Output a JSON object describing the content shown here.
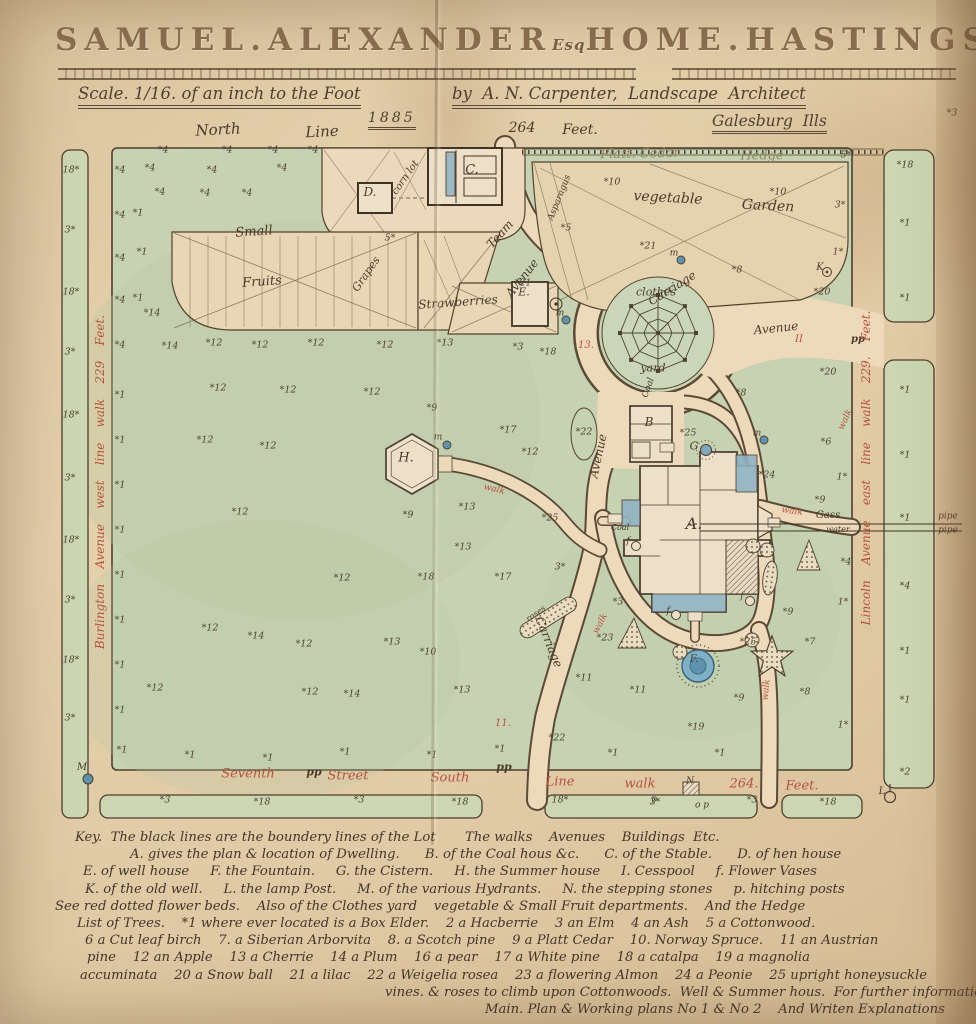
{
  "header": {
    "title_1": "SAMUEL.",
    "title_2": "ALEXANDER",
    "title_esq": "Esq",
    "title_3": "HOME.",
    "title_4": "HASTINGS.",
    "title_5": "NEB.",
    "scale": "Scale. 1/16. of an inch to the Foot",
    "byline": "by  A. N. Carpenter,  Landscape  Architect",
    "place": "Galesburg  Ills",
    "date": "1885"
  },
  "colors": {
    "paper": "#dcc6a2",
    "lawn": "#c6d2b2",
    "road_tan": "#eedaba",
    "ink": "#52432f",
    "red_script": "#b8523d",
    "water_blue": "#7fa8bd"
  },
  "map": {
    "labels": [
      {
        "n": "north-line-label",
        "t": "North",
        "x": 218,
        "y": 130,
        "r": -3,
        "s": 15
      },
      {
        "n": "north-line-label",
        "t": "Line",
        "x": 322,
        "y": 132,
        "r": -3,
        "s": 15
      },
      {
        "n": "north-feet-label",
        "t": "264",
        "x": 522,
        "y": 128,
        "s": 14
      },
      {
        "n": "north-feet-label",
        "t": "Feet.",
        "x": 580,
        "y": 130,
        "s": 14
      },
      {
        "n": "hedge-label",
        "t": "Platt. Cedar",
        "x": 640,
        "y": 154,
        "r": -1,
        "s": 13,
        "c": "faded"
      },
      {
        "n": "hedge-label",
        "t": "Hedge",
        "x": 762,
        "y": 156,
        "s": 13,
        "c": "faded"
      },
      {
        "n": "vegetable-garden-label",
        "t": "vegetable",
        "x": 668,
        "y": 198,
        "r": 3,
        "s": 14
      },
      {
        "n": "vegetable-garden-label",
        "t": "Garden",
        "x": 768,
        "y": 206,
        "r": 3,
        "s": 14
      },
      {
        "n": "asparagus-label",
        "t": "Asparagus",
        "x": 560,
        "y": 198,
        "r": -68,
        "s": 9
      },
      {
        "n": "corn-lot-label",
        "t": "corn lot",
        "x": 406,
        "y": 178,
        "r": -55,
        "s": 10
      },
      {
        "n": "small-fruits-label",
        "t": "Small",
        "x": 254,
        "y": 232,
        "r": -4,
        "s": 13
      },
      {
        "n": "small-fruits-label",
        "t": "Fruits",
        "x": 262,
        "y": 282,
        "r": -4,
        "s": 13
      },
      {
        "n": "grapes-label",
        "t": "Grapes",
        "x": 366,
        "y": 274,
        "r": -55,
        "s": 11
      },
      {
        "n": "strawberries-label",
        "t": "Strawberries",
        "x": 458,
        "y": 302,
        "r": -4,
        "s": 12
      },
      {
        "n": "team-avenue-label",
        "t": "Team",
        "x": 500,
        "y": 234,
        "r": -48,
        "s": 12
      },
      {
        "n": "team-avenue-label",
        "t": "Avenue",
        "x": 522,
        "y": 278,
        "r": -52,
        "s": 12
      },
      {
        "n": "carriage-avenue-label",
        "t": "Carriage",
        "x": 672,
        "y": 288,
        "r": -32,
        "s": 12
      },
      {
        "n": "carriage-avenue-label",
        "t": "Avenue",
        "x": 776,
        "y": 328,
        "r": -6,
        "s": 12
      },
      {
        "n": "clothes-yard-label",
        "t": "clothes",
        "x": 656,
        "y": 292,
        "s": 11
      },
      {
        "n": "clothes-yard-label",
        "t": "yard",
        "x": 653,
        "y": 368,
        "s": 11
      },
      {
        "n": "avenue-label",
        "t": "Avenue",
        "x": 598,
        "y": 456,
        "r": -78,
        "s": 12
      },
      {
        "n": "carriage-drive-label",
        "t": "Carriage",
        "x": 549,
        "y": 642,
        "r": 68,
        "s": 12
      },
      {
        "n": "coal-label",
        "t": "Coal",
        "x": 649,
        "y": 388,
        "r": -70,
        "s": 9
      },
      {
        "n": "coal-label",
        "t": "Coal",
        "x": 620,
        "y": 528,
        "s": 8
      },
      {
        "n": "gas-pipe-label",
        "t": "Gass",
        "x": 828,
        "y": 516,
        "s": 10
      },
      {
        "n": "water-pipe-label",
        "t": "water",
        "x": 838,
        "y": 530,
        "s": 8
      },
      {
        "n": "pipe-label",
        "t": "pipe",
        "x": 948,
        "y": 517,
        "s": 9
      },
      {
        "n": "pipe-label",
        "t": "pipe",
        "x": 948,
        "y": 531,
        "s": 9
      },
      {
        "n": "roses-bed-label",
        "t": "roses",
        "x": 536,
        "y": 614,
        "r": -35,
        "s": 8
      },
      {
        "n": "walk-label",
        "t": "walk",
        "x": 494,
        "y": 490,
        "r": 14,
        "s": 9,
        "c": "red"
      },
      {
        "n": "walk-label",
        "t": "walk",
        "x": 792,
        "y": 512,
        "r": 8,
        "s": 9,
        "c": "red"
      },
      {
        "n": "walk-label",
        "t": "walk",
        "x": 601,
        "y": 624,
        "r": -62,
        "s": 9,
        "c": "red"
      },
      {
        "n": "walk-label",
        "t": "walk",
        "x": 767,
        "y": 690,
        "r": -84,
        "s": 9,
        "c": "red"
      },
      {
        "n": "walk-label",
        "t": "walk",
        "x": 846,
        "y": 420,
        "r": -65,
        "s": 9,
        "c": "red"
      },
      {
        "n": "station-mark",
        "t": "13.",
        "x": 586,
        "y": 346,
        "s": 10,
        "c": "red"
      },
      {
        "n": "station-mark",
        "t": "11.",
        "x": 503,
        "y": 724,
        "s": 10,
        "c": "red"
      },
      {
        "n": "station-mark",
        "t": "II",
        "x": 799,
        "y": 340,
        "s": 10,
        "c": "red"
      },
      {
        "n": "hitching-posts-mark",
        "t": "pp",
        "x": 314,
        "y": 772,
        "s": 11,
        "b": 1
      },
      {
        "n": "hitching-posts-mark",
        "t": "pp",
        "x": 504,
        "y": 767,
        "s": 11,
        "b": 1
      },
      {
        "n": "hitching-posts-mark",
        "t": "pp",
        "x": 858,
        "y": 340,
        "s": 10,
        "b": 1
      },
      {
        "n": "post-mark",
        "t": "p",
        "x": 654,
        "y": 800,
        "s": 9
      },
      {
        "n": "post-mark",
        "t": "o p",
        "x": 702,
        "y": 806,
        "s": 9
      },
      {
        "n": "west-street-label",
        "t": "Burlington    Avenue    west    line    walk    229    Feet.",
        "x": 100,
        "y": 482,
        "r": -90,
        "s": 12,
        "c": "red"
      },
      {
        "n": "east-street-label",
        "t": "Lincoln    Avenue    east    line    walk    229.    Feet.",
        "x": 866,
        "y": 468,
        "r": -90,
        "s": 12,
        "c": "red"
      },
      {
        "n": "south-street-label",
        "t": "Seventh",
        "x": 248,
        "y": 774,
        "s": 13,
        "c": "red"
      },
      {
        "n": "south-street-label",
        "t": "Street",
        "x": 348,
        "y": 776,
        "s": 13,
        "c": "red"
      },
      {
        "n": "south-street-label",
        "t": "South",
        "x": 450,
        "y": 778,
        "s": 13,
        "c": "red"
      },
      {
        "n": "south-street-label",
        "t": "Line",
        "x": 560,
        "y": 782,
        "s": 13,
        "c": "red"
      },
      {
        "n": "south-street-label",
        "t": "walk",
        "x": 640,
        "y": 784,
        "s": 13,
        "c": "red"
      },
      {
        "n": "south-street-label",
        "t": "264.",
        "x": 744,
        "y": 784,
        "s": 13,
        "c": "red"
      },
      {
        "n": "south-street-label",
        "t": "Feet.",
        "x": 802,
        "y": 786,
        "s": 13,
        "c": "red"
      },
      {
        "n": "label-stable-C",
        "t": "C.",
        "x": 472,
        "y": 170,
        "s": 13
      },
      {
        "n": "label-hen-house-D",
        "t": "D.",
        "x": 370,
        "y": 192,
        "s": 12
      },
      {
        "n": "label-coal-house-B",
        "t": "B",
        "x": 649,
        "y": 422,
        "s": 12
      },
      {
        "n": "label-well-house-E",
        "t": "E.",
        "x": 524,
        "y": 292,
        "s": 11
      },
      {
        "n": "label-dwelling-A",
        "t": "A.",
        "x": 694,
        "y": 524,
        "s": 16
      },
      {
        "n": "label-summer-house-H",
        "t": "H.",
        "x": 406,
        "y": 458,
        "s": 13
      },
      {
        "n": "label-fountain-F",
        "t": "F.",
        "x": 694,
        "y": 660,
        "s": 10
      },
      {
        "n": "label-cistern-G",
        "t": "G",
        "x": 694,
        "y": 446,
        "s": 11
      },
      {
        "n": "label-old-well-K",
        "t": "K",
        "x": 820,
        "y": 268,
        "s": 10
      },
      {
        "n": "label-stepping-stones-N",
        "t": "N",
        "x": 690,
        "y": 782,
        "s": 9
      },
      {
        "n": "label-lamp-post-L",
        "t": "L",
        "x": 882,
        "y": 792,
        "s": 10
      },
      {
        "n": "label-hydrant-M",
        "t": "M",
        "x": 82,
        "y": 768,
        "s": 10
      },
      {
        "n": "hydrant-label",
        "t": "m",
        "x": 560,
        "y": 314,
        "s": 9
      },
      {
        "n": "hydrant-label",
        "t": "m",
        "x": 757,
        "y": 434,
        "s": 9
      },
      {
        "n": "hydrant-label",
        "t": "m",
        "x": 438,
        "y": 438,
        "s": 9
      },
      {
        "n": "hydrant-label",
        "t": "m",
        "x": 674,
        "y": 254,
        "s": 9
      },
      {
        "n": "flower-vase-label",
        "t": "f",
        "x": 628,
        "y": 542,
        "s": 9
      },
      {
        "n": "flower-vase-label",
        "t": "f",
        "x": 742,
        "y": 597,
        "s": 9
      },
      {
        "n": "flower-vase-label",
        "t": "f",
        "x": 668,
        "y": 612,
        "s": 9
      }
    ],
    "trees": [
      [
        163,
        150,
        "*4"
      ],
      [
        227,
        150,
        "*4"
      ],
      [
        273,
        150,
        "*4"
      ],
      [
        313,
        150,
        "*4"
      ],
      [
        150,
        168,
        "*4"
      ],
      [
        212,
        170,
        "*4"
      ],
      [
        282,
        168,
        "*4"
      ],
      [
        160,
        192,
        "*4"
      ],
      [
        205,
        193,
        "*4"
      ],
      [
        247,
        193,
        "*4"
      ],
      [
        138,
        213,
        "*1"
      ],
      [
        142,
        252,
        "*1"
      ],
      [
        138,
        298,
        "*1"
      ],
      [
        152,
        313,
        "*14"
      ],
      [
        120,
        170,
        "*4"
      ],
      [
        120,
        215,
        "*4"
      ],
      [
        120,
        258,
        "*4"
      ],
      [
        120,
        300,
        "*4"
      ],
      [
        120,
        345,
        "*4"
      ],
      [
        120,
        395,
        "*1"
      ],
      [
        120,
        440,
        "*1"
      ],
      [
        120,
        485,
        "*1"
      ],
      [
        120,
        530,
        "*1"
      ],
      [
        120,
        575,
        "*1"
      ],
      [
        120,
        620,
        "*1"
      ],
      [
        120,
        665,
        "*1"
      ],
      [
        120,
        710,
        "*1"
      ],
      [
        122,
        750,
        "*1"
      ],
      [
        71,
        170,
        "18*"
      ],
      [
        70,
        230,
        "3*"
      ],
      [
        71,
        292,
        "18*"
      ],
      [
        70,
        352,
        "3*"
      ],
      [
        71,
        415,
        "18*"
      ],
      [
        70,
        478,
        "3*"
      ],
      [
        71,
        540,
        "18*"
      ],
      [
        70,
        600,
        "3*"
      ],
      [
        71,
        660,
        "18*"
      ],
      [
        70,
        718,
        "3*"
      ],
      [
        170,
        346,
        "*14"
      ],
      [
        214,
        343,
        "*12"
      ],
      [
        260,
        345,
        "*12"
      ],
      [
        316,
        343,
        "*12"
      ],
      [
        385,
        345,
        "*12"
      ],
      [
        445,
        343,
        "*13"
      ],
      [
        518,
        347,
        "*3"
      ],
      [
        548,
        352,
        "*18"
      ],
      [
        218,
        388,
        "*12"
      ],
      [
        288,
        390,
        "*12"
      ],
      [
        372,
        392,
        "*12"
      ],
      [
        432,
        408,
        "*9"
      ],
      [
        205,
        440,
        "*12"
      ],
      [
        268,
        446,
        "*12"
      ],
      [
        508,
        430,
        "*17"
      ],
      [
        530,
        452,
        "*12"
      ],
      [
        240,
        512,
        "*12"
      ],
      [
        408,
        515,
        "*9"
      ],
      [
        467,
        507,
        "*13"
      ],
      [
        550,
        518,
        "*25"
      ],
      [
        463,
        547,
        "*13"
      ],
      [
        342,
        578,
        "*12"
      ],
      [
        426,
        577,
        "*18"
      ],
      [
        503,
        577,
        "*17"
      ],
      [
        560,
        567,
        "3*"
      ],
      [
        155,
        688,
        "*12"
      ],
      [
        210,
        628,
        "*12"
      ],
      [
        256,
        636,
        "*14"
      ],
      [
        304,
        644,
        "*12"
      ],
      [
        392,
        642,
        "*13"
      ],
      [
        428,
        652,
        "*10"
      ],
      [
        310,
        692,
        "*12"
      ],
      [
        352,
        694,
        "*14"
      ],
      [
        462,
        690,
        "*13"
      ],
      [
        190,
        755,
        "*1"
      ],
      [
        268,
        758,
        "*1"
      ],
      [
        345,
        752,
        "*1"
      ],
      [
        432,
        755,
        "*1"
      ],
      [
        500,
        749,
        "*1"
      ],
      [
        584,
        678,
        "*11"
      ],
      [
        638,
        690,
        "*11"
      ],
      [
        557,
        738,
        "*22"
      ],
      [
        613,
        753,
        "*1"
      ],
      [
        696,
        727,
        "*19"
      ],
      [
        739,
        698,
        "*9"
      ],
      [
        720,
        753,
        "*1"
      ],
      [
        618,
        602,
        "*3"
      ],
      [
        605,
        638,
        "*23"
      ],
      [
        748,
        642,
        "*25"
      ],
      [
        826,
        442,
        "*6"
      ],
      [
        741,
        393,
        "*8"
      ],
      [
        828,
        372,
        "*20"
      ],
      [
        820,
        500,
        "*9"
      ],
      [
        842,
        477,
        "1*"
      ],
      [
        846,
        562,
        "*4"
      ],
      [
        810,
        642,
        "*7"
      ],
      [
        843,
        602,
        "1*"
      ],
      [
        805,
        692,
        "*8"
      ],
      [
        843,
        725,
        "1*"
      ],
      [
        788,
        612,
        "*9"
      ],
      [
        846,
        155,
        "5*"
      ],
      [
        840,
        205,
        "3*"
      ],
      [
        838,
        252,
        "1*"
      ],
      [
        822,
        292,
        "*20"
      ],
      [
        612,
        182,
        "*10"
      ],
      [
        778,
        192,
        "*10"
      ],
      [
        737,
        270,
        "*8"
      ],
      [
        648,
        246,
        "*21"
      ],
      [
        566,
        228,
        "*5"
      ],
      [
        523,
        283,
        "*21"
      ],
      [
        390,
        238,
        "5*"
      ],
      [
        688,
        433,
        "*25"
      ],
      [
        767,
        475,
        "*24"
      ],
      [
        584,
        432,
        "*22"
      ],
      [
        905,
        165,
        "*18"
      ],
      [
        905,
        223,
        "*1"
      ],
      [
        905,
        298,
        "*1"
      ],
      [
        905,
        390,
        "*1"
      ],
      [
        905,
        455,
        "*1"
      ],
      [
        905,
        518,
        "*1"
      ],
      [
        905,
        586,
        "*4"
      ],
      [
        905,
        651,
        "*1"
      ],
      [
        905,
        700,
        "*1"
      ],
      [
        905,
        772,
        "*2"
      ],
      [
        165,
        800,
        "*3"
      ],
      [
        262,
        802,
        "*18"
      ],
      [
        359,
        800,
        "*3"
      ],
      [
        460,
        802,
        "*18"
      ],
      [
        560,
        800,
        "18*"
      ],
      [
        655,
        802,
        "3*"
      ],
      [
        752,
        800,
        "*3"
      ],
      [
        828,
        802,
        "*18"
      ],
      [
        952,
        113,
        "*3"
      ]
    ]
  },
  "key": {
    "lines": [
      {
        "indent": 20,
        "text": "Key.  The black lines are the boundery lines of the Lot       The walks    Avenues    Buildings  Etc."
      },
      {
        "indent": 75,
        "text": "A. gives the plan & location of Dwelling.      B. of the Coal hous &c.      C. of the Stable.      D. of hen house"
      },
      {
        "indent": 28,
        "text": "E. of well house     F. the Fountain.     G. the Cistern.     H. the Summer house     I. Cesspool     f. Flower Vases"
      },
      {
        "indent": 30,
        "text": "K. of the old well.     L. the lamp Post.     M. of the various Hydrants.     N. the stepping stones     p. hitching posts"
      },
      {
        "indent": 0,
        "text": "See red dotted flower beds.    Also of the Clothes yard    vegetable & Small Fruit departments.    And the Hedge"
      },
      {
        "indent": 22,
        "text": "List of Trees.    *1 where ever located is a Box Elder.    2 a Hacberrie    3 an Elm    4 an Ash    5 a Cottonwood."
      },
      {
        "indent": 30,
        "text": "6 a Cut leaf birch    7. a Siberian Arborvita    8. a Scotch pine    9 a Platt Cedar    10. Norway Spruce.    11 an Austrian"
      },
      {
        "indent": 32,
        "text": "pine    12 an Apple    13 a Cherrie    14 a Plum    16 a pear    17 a White pine    18 a catalpa    19 a magnolia"
      },
      {
        "indent": 25,
        "text": "accuminata    20 a Snow ball    21 a lilac    22 a Weigelia rosea    23 a flowering Almon    24 a Peonie    25 upright honeysuckle"
      },
      {
        "indent": 330,
        "text": "vines. & roses to climb upon Cottonwoods.  Well & Summer hous.  For further information See the"
      },
      {
        "indent": 430,
        "text": "Main. Plan & Working plans No 1 & No 2    And Writen Explanations"
      }
    ]
  }
}
